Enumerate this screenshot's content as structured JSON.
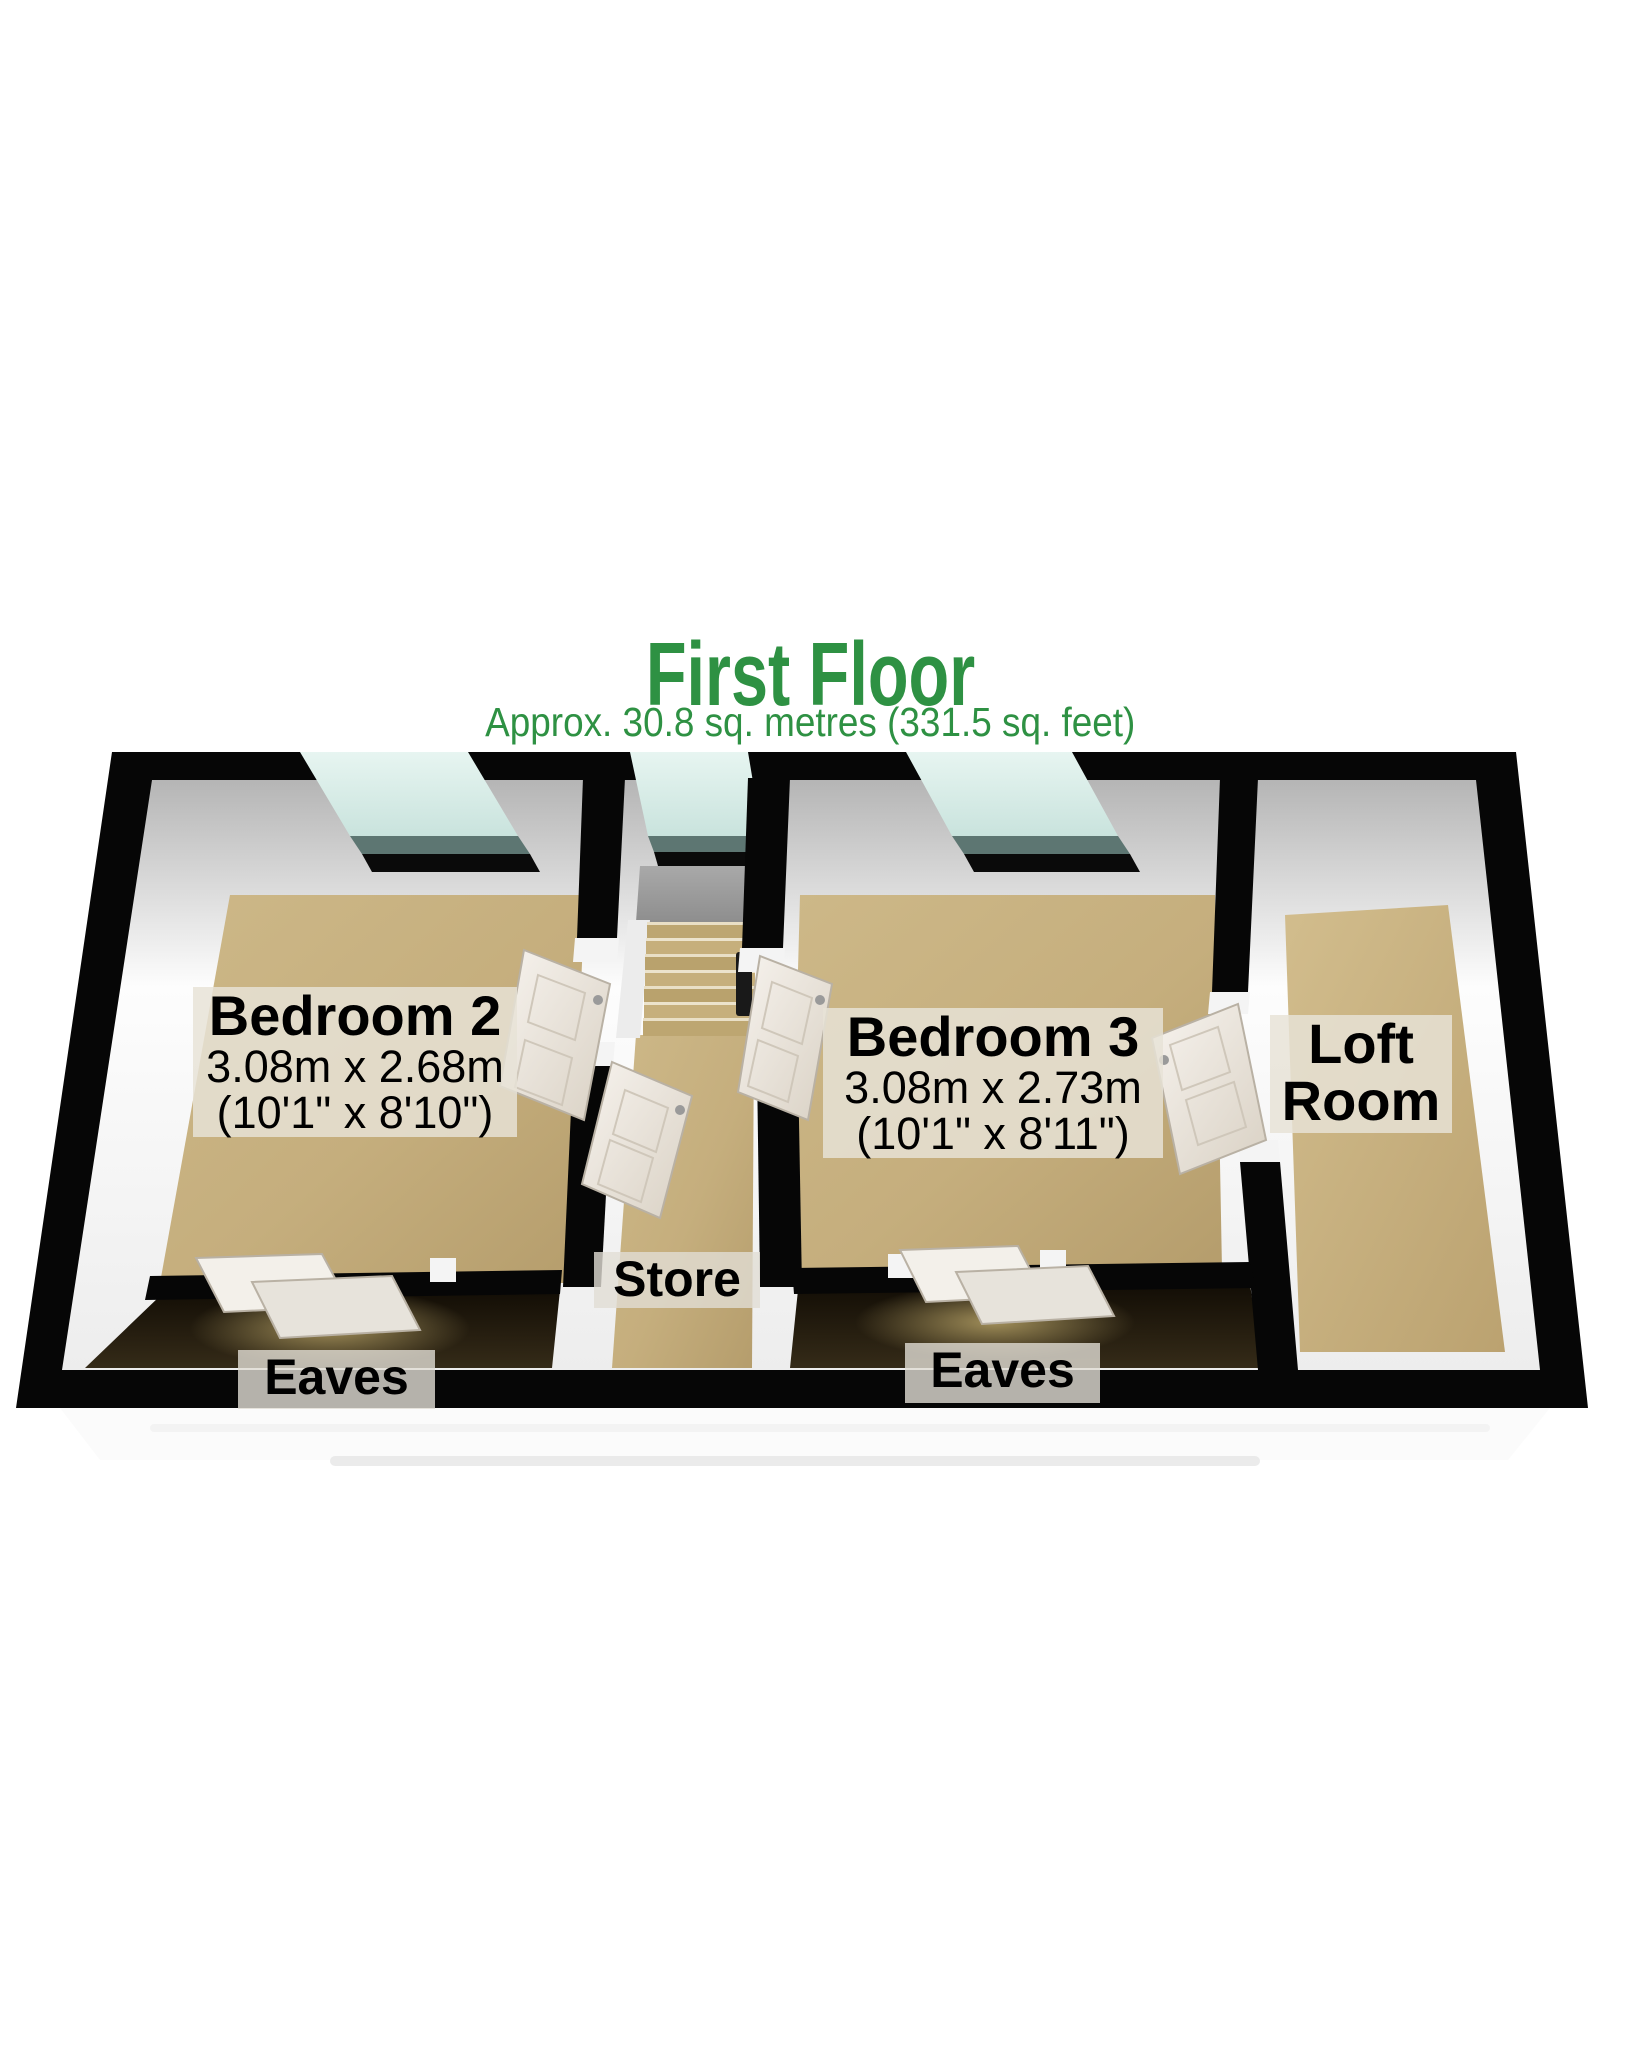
{
  "title": {
    "text": "First Floor",
    "area": "Approx. 30.8 sq. metres (331.5 sq. feet)"
  },
  "rooms": {
    "bedroom2": {
      "name": "Bedroom 2",
      "dimensions_metric": "3.08m x 2.68m",
      "dimensions_imperial": "(10'1\" x 8'10\")"
    },
    "bedroom3": {
      "name": "Bedroom 3",
      "dimensions_metric": "3.08m x 2.73m",
      "dimensions_imperial": "(10'1\" x 8'11\")"
    },
    "loft": {
      "name_line1": "Loft",
      "name_line2": "Room"
    },
    "store": {
      "name": "Store"
    },
    "eaves_left": {
      "name": "Eaves"
    },
    "eaves_right": {
      "name": "Eaves"
    }
  },
  "colors": {
    "title_green": "#2e9143",
    "wall_black": "#060606",
    "wall_white": "#f5f5f5",
    "floor_tan": "#c5ae7d",
    "eaves_dark": "#1d160a",
    "window_glass": "#dcefeb",
    "window_sill": "#5d7672",
    "door_white": "#f1ece5",
    "label_background": "rgba(231,226,215,0.84)"
  }
}
